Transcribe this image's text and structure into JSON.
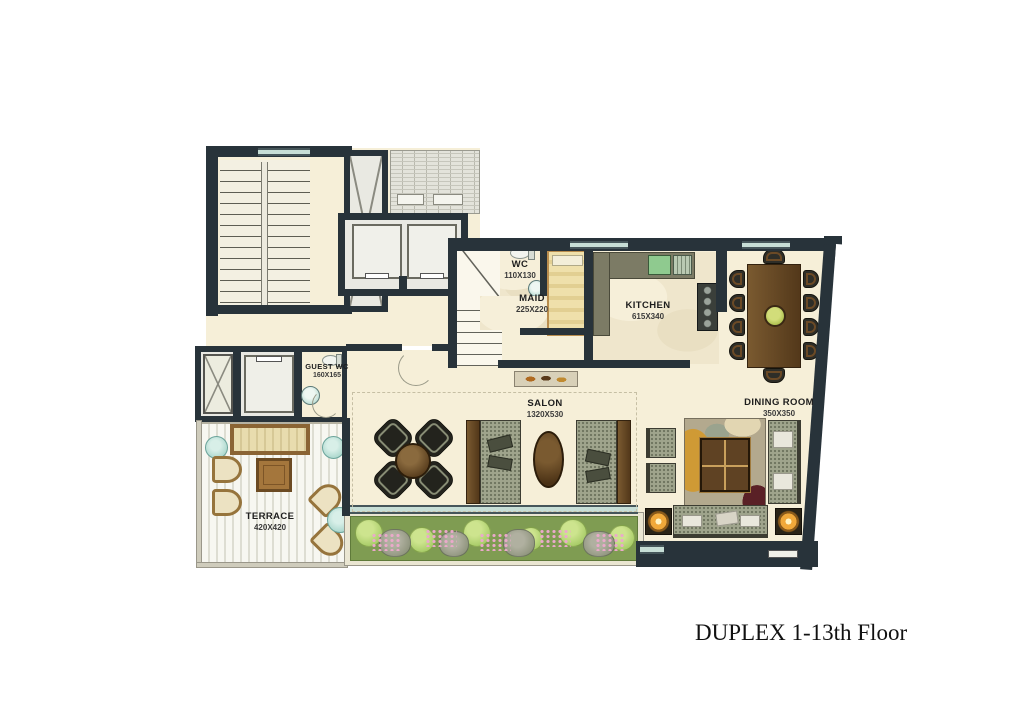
{
  "caption": {
    "text": "DUPLEX 1-13th Floor"
  },
  "rooms": {
    "wc": {
      "name": "WC",
      "dims": "110X130"
    },
    "maid": {
      "name": "MAID",
      "dims": "225X220"
    },
    "kitchen": {
      "name": "KITCHEN",
      "dims": "615X340"
    },
    "dining": {
      "name": "DINING ROOM",
      "dims": "350X350"
    },
    "salon": {
      "name": "SALON",
      "dims": "1320X530"
    },
    "guest_wc": {
      "name": "GUEST WC",
      "dims": "160X165"
    },
    "terrace": {
      "name": "TERRACE",
      "dims": "420X420"
    }
  },
  "colors": {
    "wall": "#28333a",
    "floor_cream": "#f6efd8",
    "floor_marble": "#efe6cc",
    "window_teal": "#c7ded6",
    "counter_olive": "#7c7b65",
    "wood_brown": "#6b4a26",
    "planter_green": "#7f9c52",
    "lamp_gold": "#f0a83a"
  }
}
